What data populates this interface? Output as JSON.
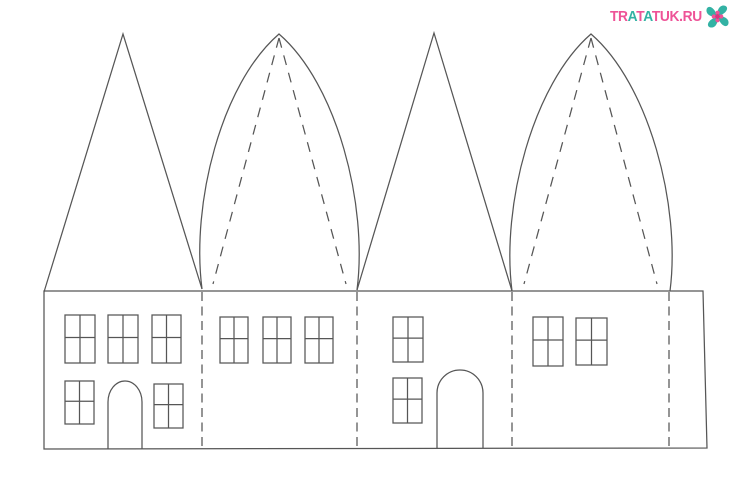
{
  "page": {
    "width": 735,
    "height": 484,
    "background": "#ffffff"
  },
  "watermark": {
    "text": "TRATATUK.RU",
    "letters": [
      {
        "ch": "T",
        "color": "pink"
      },
      {
        "ch": "R",
        "color": "pink"
      },
      {
        "ch": "A",
        "color": "teal"
      },
      {
        "ch": "T",
        "color": "pink"
      },
      {
        "ch": "A",
        "color": "teal"
      },
      {
        "ch": "T",
        "color": "pink"
      },
      {
        "ch": "U",
        "color": "pink"
      },
      {
        "ch": "K",
        "color": "pink"
      },
      {
        "ch": ".",
        "color": "pink"
      },
      {
        "ch": "R",
        "color": "pink"
      },
      {
        "ch": "U",
        "color": "pink"
      }
    ],
    "colors": {
      "pink": "#ee5397",
      "teal": "#33b2a4",
      "pink_dark": "#d8357f"
    }
  },
  "template": {
    "stroke": {
      "color": "#565656",
      "width": 1.25,
      "fold_dash": "9 5.5",
      "roof_dash": "10 8"
    },
    "body": {
      "top_left": [
        44,
        291
      ],
      "top_right": [
        703,
        291
      ],
      "bottom_right": [
        707,
        448
      ],
      "bottom_left": [
        44,
        449
      ]
    },
    "fold_lines": {
      "xs": [
        202,
        357,
        512,
        669
      ],
      "y_top": 292,
      "y_bottom": 448
    },
    "roofs": [
      {
        "type": "triangle",
        "base_left": [
          44,
          292
        ],
        "apex": [
          123,
          34
        ],
        "base_right": [
          202,
          289
        ]
      },
      {
        "type": "ogive",
        "base_left": [
          202,
          289
        ],
        "apex": [
          279,
          34
        ],
        "base_right": [
          357,
          290
        ],
        "dash_left_end": [
          213,
          284
        ],
        "dash_right_end": [
          346,
          284
        ]
      },
      {
        "type": "triangle",
        "base_left": [
          357,
          290
        ],
        "apex": [
          434,
          33
        ],
        "base_right": [
          512,
          291
        ]
      },
      {
        "type": "ogive",
        "base_left": [
          512,
          291
        ],
        "apex": [
          591,
          34
        ],
        "base_right": [
          670,
          291
        ],
        "dash_left_end": [
          524,
          284
        ],
        "dash_right_end": [
          657,
          284
        ]
      }
    ],
    "windows": [
      {
        "x": 65,
        "y": 315,
        "w": 30,
        "h": 48
      },
      {
        "x": 108,
        "y": 315,
        "w": 30,
        "h": 48
      },
      {
        "x": 152,
        "y": 315,
        "w": 29,
        "h": 48
      },
      {
        "x": 65,
        "y": 381,
        "w": 29,
        "h": 43
      },
      {
        "x": 154,
        "y": 384,
        "w": 29,
        "h": 44
      },
      {
        "x": 220,
        "y": 317,
        "w": 28,
        "h": 46
      },
      {
        "x": 263,
        "y": 317,
        "w": 28,
        "h": 46
      },
      {
        "x": 305,
        "y": 317,
        "w": 28,
        "h": 46
      },
      {
        "x": 393,
        "y": 317,
        "w": 30,
        "h": 45
      },
      {
        "x": 393,
        "y": 378,
        "w": 29,
        "h": 45
      },
      {
        "x": 533,
        "y": 317,
        "w": 30,
        "h": 49
      },
      {
        "x": 576,
        "y": 318,
        "w": 31,
        "h": 47
      }
    ],
    "doors": [
      {
        "x": 108,
        "y": 381,
        "w": 34,
        "h": 68,
        "arch": 21
      },
      {
        "x": 437,
        "y": 370,
        "w": 46,
        "h": 78,
        "arch": 23
      }
    ]
  }
}
